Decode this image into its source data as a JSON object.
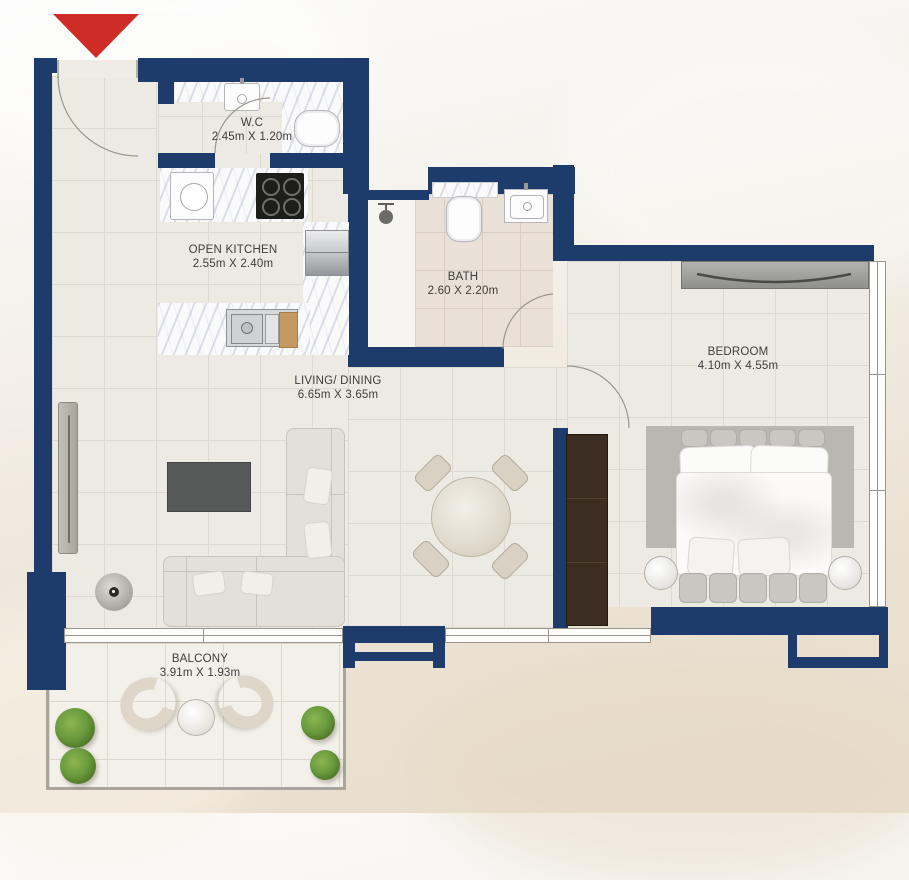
{
  "plan_title": "apartment-floor-plan",
  "entry": {
    "marker": "entrance-arrow"
  },
  "rooms": [
    {
      "name": "W.C",
      "dims": "2.45m X 1.20m"
    },
    {
      "name": "OPEN KITCHEN",
      "dims": "2.55m X 2.40m"
    },
    {
      "name": "BATH",
      "dims": "2.60 X 2.20m"
    },
    {
      "name": "LIVING/ DINING",
      "dims": "6.65m X 3.65m"
    },
    {
      "name": "BEDROOM",
      "dims": "4.10m X 4.55m"
    },
    {
      "name": "BALCONY",
      "dims": "3.91m X 1.93m"
    }
  ],
  "colors": {
    "wall": "#1e3c6b",
    "entry_arrow": "#cf2b27",
    "floor_tile": "#edeae3",
    "marble": "#fafafb",
    "wardrobe_wood": "#3c2c21",
    "chopping_board": "#c59a62",
    "plant_green": "#6a9b3e"
  },
  "icons": [
    "entrance-arrow-icon",
    "door-swing-arc",
    "shower-head-icon",
    "toilet-icon",
    "sink-icon",
    "cooktop-icon",
    "fridge-icon",
    "bed-icon",
    "sofa-icon",
    "dining-table-icon",
    "tv-icon",
    "floor-lamp-icon",
    "plant-icon",
    "balcony-chair-icon"
  ]
}
